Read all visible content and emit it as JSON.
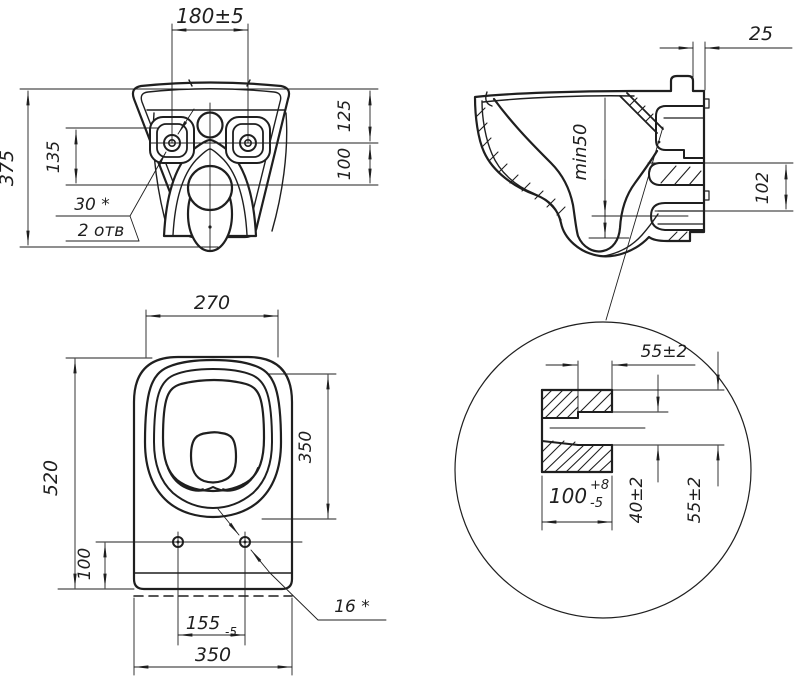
{
  "drawing": {
    "background": "#ffffff",
    "line_color": "#1f1f1f",
    "front_view": {
      "dim_hole_spacing": "180±5",
      "dim_overall_height": "375",
      "dim_hole_height": "135",
      "dim_rim_to_holes": "125",
      "dim_holes_to_outlet": "100",
      "note_hole_diameter": "30 *",
      "note_hole_count": "2 отв"
    },
    "side_view": {
      "dim_wall_gap": "25",
      "dim_water_seal": "min50",
      "dim_outlet_height": "102"
    },
    "top_view": {
      "dim_seat_width": "270",
      "dim_overall_depth": "520",
      "dim_bowl_depth": "350",
      "dim_hole_offset": "100",
      "dim_hole_spacing": "155",
      "dim_hole_spacing_tolerance": "-5",
      "dim_overall_width": "350",
      "note_hole_diameter": "16 *"
    },
    "detail_view": {
      "dim_spigot_length": "55±2",
      "dim_bore_depth": "100",
      "dim_bore_tolerance_upper": "+8",
      "dim_bore_tolerance_lower": "-5",
      "dim_bore_diameter": "40±2",
      "dim_spigot_diameter": "55±2"
    }
  }
}
